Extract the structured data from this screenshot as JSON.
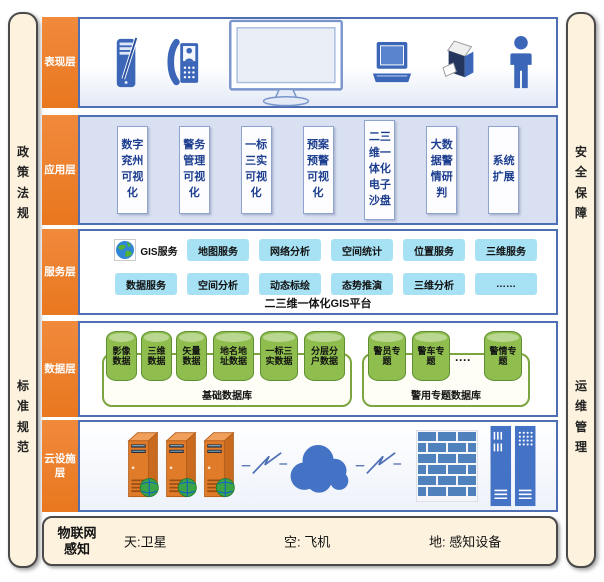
{
  "frame": {
    "left_top": "政策法规",
    "left_bottom": "标准规范",
    "right_top": "安全保障",
    "right_bottom": "运维管理"
  },
  "presentation": {
    "label": "表现层",
    "icons": [
      "pda-icon",
      "videophone-icon",
      "monitor-icon",
      "laptop-icon",
      "printer-icon",
      "person-icon"
    ]
  },
  "application": {
    "label": "应用层",
    "boxes": [
      "数字兖州可视化",
      "警务管理可视化",
      "一标三实可视化",
      "预案预警可视化",
      "二三维一体化电子沙盘",
      "大数据警情研判",
      "系统扩展"
    ]
  },
  "service": {
    "label": "服务层",
    "gis": "GIS服务",
    "row1": [
      "地图服务",
      "网络分析",
      "空间统计",
      "位置服务",
      "三维服务"
    ],
    "row2": [
      "数据服务",
      "空间分析",
      "动态标绘",
      "态势推演",
      "三维分析",
      "……"
    ],
    "platform": "二三维一体化GIS平台"
  },
  "data_layer": {
    "label": "数据层",
    "base_group": {
      "name": "基础数据库",
      "cylinders": [
        "影像数据",
        "三维数据",
        "矢量数据",
        "地名地址数据",
        "一标三实数据",
        "分层分户数据"
      ]
    },
    "police_group": {
      "name": "警用专题数据库",
      "cylinders": [
        "警员专题",
        "警车专题",
        "警情专题"
      ],
      "ellipsis": "····"
    }
  },
  "cloud": {
    "label": "云设施层",
    "icons": [
      "server-icon",
      "server-icon",
      "server-icon",
      "lightning-icon",
      "cloud-icon",
      "lightning-icon",
      "firewall-icon",
      "server-rack-icon"
    ]
  },
  "iot": {
    "label": "物联网感知",
    "items": [
      "天:卫星",
      "空: 飞机",
      "地: 感知设备"
    ]
  },
  "colors": {
    "accent_orange": "#ED7D31",
    "border_blue": "#4F6FB5",
    "app_bg": "#D9E0F2",
    "tile_cyan": "#A6E1F4",
    "cylinder_green": "#8FBE4E",
    "group_border_green": "#7CA53F",
    "cream": "#FCF2DE",
    "icon_blue": "#4472C4"
  }
}
